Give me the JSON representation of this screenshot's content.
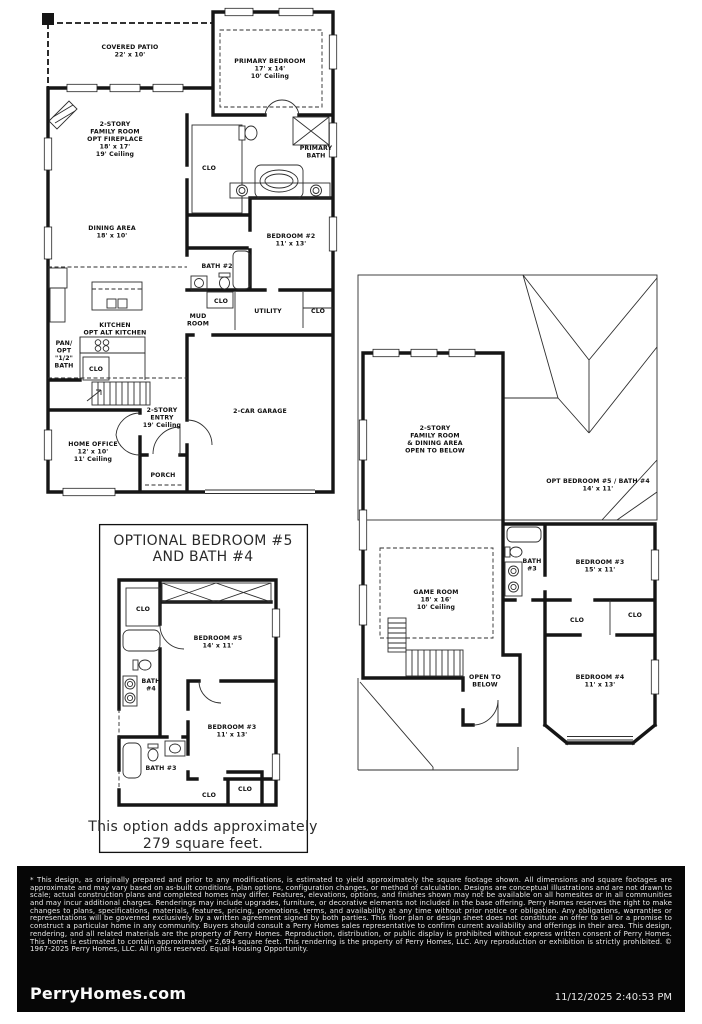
{
  "colors": {
    "ink": "#151515",
    "paper": "#ffffff",
    "legal_bg": "#060606",
    "legal_text": "#f2f2f2"
  },
  "first_floor": {
    "covered_patio": {
      "l1": "COVERED PATIO",
      "l2": "22' x 10'"
    },
    "primary_bedroom": {
      "l1": "PRIMARY BEDROOM",
      "l2": "17' x 14'",
      "l3": "10' Ceiling"
    },
    "family_room": {
      "l1": "2-STORY",
      "l2": "FAMILY ROOM",
      "l3": "OPT  FIREPLACE",
      "l4": "18' x 17'",
      "l5": "19' Ceiling"
    },
    "primary_bath": {
      "l1": "PRIMARY",
      "l2": "BATH"
    },
    "primary_clo": "CLO",
    "dining": {
      "l1": "DINING AREA",
      "l2": "18' x 10'"
    },
    "bedroom2": {
      "l1": "BEDROOM #2",
      "l2": "11' x 13'"
    },
    "bath2": "BATH #2",
    "mud": {
      "l1": "MUD",
      "l2": "ROOM"
    },
    "utility": "UTILITY",
    "clo_mid": "CLO",
    "clo_right": "CLO",
    "kitchen": {
      "l1": "KITCHEN",
      "l2": "OPT  ALT  KITCHEN"
    },
    "pantry": {
      "l1": "PAN/",
      "l2": "OPT",
      "l3": "\"1/2\"",
      "l4": "BATH"
    },
    "clo_kitchen": "CLO",
    "entry": {
      "l1": "2-STORY",
      "l2": "ENTRY",
      "l3": "19' Ceiling"
    },
    "home_office": {
      "l1": "HOME OFFICE",
      "l2": "12' x 10'",
      "l3": "11' Ceiling"
    },
    "porch": "PORCH",
    "garage": "2-CAR GARAGE"
  },
  "second_floor": {
    "family_open": {
      "l1": "2-STORY",
      "l2": "FAMILY ROOM",
      "l3": "& DINING AREA",
      "l4": "OPEN TO BELOW"
    },
    "opt_bed5": {
      "l1": "OPT  BEDROOM #5 / BATH #4",
      "l2": "14' x 11'"
    },
    "game_room": {
      "l1": "GAME ROOM",
      "l2": "18' x 16'",
      "l3": "10' Ceiling"
    },
    "bath3": {
      "l1": "BATH",
      "l2": "#3"
    },
    "bedroom3": {
      "l1": "BEDROOM #3",
      "l2": "15' x 11'"
    },
    "clo_a": "CLO",
    "clo_b": "CLO",
    "bedroom4": {
      "l1": "BEDROOM #4",
      "l2": "11' x 13'"
    },
    "open_below": {
      "l1": "OPEN TO",
      "l2": "BELOW"
    }
  },
  "optional": {
    "title1": "OPTIONAL BEDROOM #5",
    "title2": "AND BATH #4",
    "clo_top": "CLO",
    "bedroom5": {
      "l1": "BEDROOM #5",
      "l2": "14' x 11'"
    },
    "bath4": {
      "l1": "BATH",
      "l2": "#4"
    },
    "bedroom3": {
      "l1": "BEDROOM #3",
      "l2": "11' x 13'"
    },
    "bath3": "BATH #3",
    "clo_a": "CLO",
    "clo_b": "CLO",
    "caption1": "This option adds approximately",
    "caption2": "279 square feet."
  },
  "footer": {
    "disclaimer": "* This design, as originally prepared and prior to any modifications, is estimated to yield approximately the square footage shown.  All dimensions and square footages are approximate and may vary based on as-built conditions, plan options, configuration changes, or method of calculation.  Designs are conceptual illustrations and are not drawn to scale; actual construction plans and completed homes may differ.  Features, elevations, options, and finishes shown may not be available on all homesites or in all communities and may incur additional charges.  Renderings may include upgrades, furniture, or decorative elements not included in the base offering.  Perry Homes reserves the right to make changes to plans, specifications, materials, features, pricing, promotions, terms, and availability at any time without prior notice or obligation.  Any obligations, warranties or representations will be governed exclusively by a written agreement signed by both parties.  This floor plan or design sheet does not constitute an offer to sell or a promise to construct a particular home in any community.  Buyers should consult a Perry Homes sales representative to confirm current availability and offerings in their area.  This design, rendering, and all related materials are the property of Perry Homes.  Reproduction, distribution, or public display is prohibited without express written consent of Perry Homes.  This home is estimated to contain approximately* 2,694 square feet.  This rendering is the property of Perry Homes, LLC.  Any reproduction or exhibition is strictly prohibited. © 1967-2025 Perry Homes, LLC.  All rights reserved.  Equal Housing Opportunity.",
    "brand": "PerryHomes.com",
    "timestamp": "11/12/2025 2:40:53 PM"
  }
}
